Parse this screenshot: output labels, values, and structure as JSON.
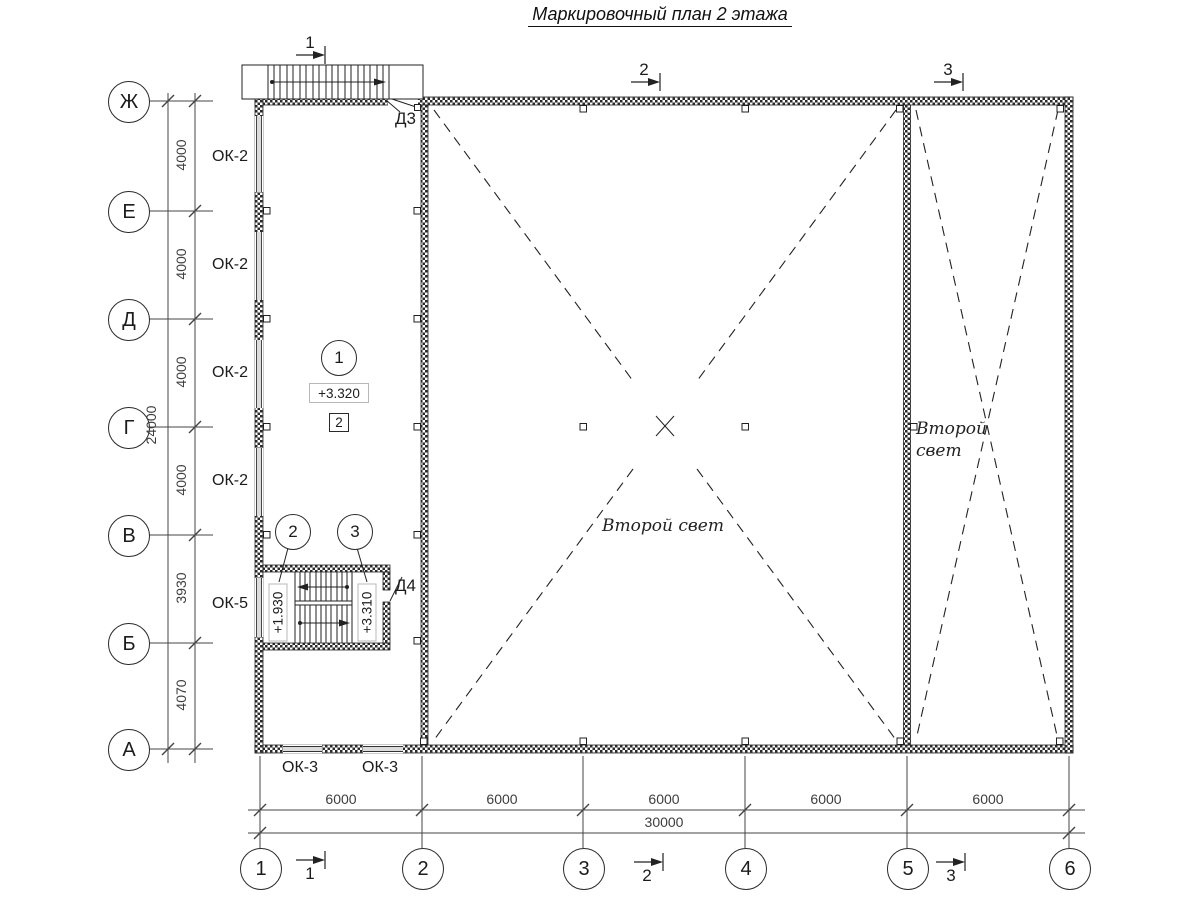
{
  "title": "Маркировочный план 2 этажа",
  "axes": {
    "rows": [
      "Ж",
      "Е",
      "Д",
      "Г",
      "В",
      "Б",
      "А"
    ],
    "cols": [
      "1",
      "2",
      "3",
      "4",
      "5",
      "6"
    ]
  },
  "dimensions": {
    "vertical_segments": [
      "4000",
      "4000",
      "4000",
      "4000",
      "3930",
      "4070"
    ],
    "vertical_total": "24000",
    "horizontal_segments": [
      "6000",
      "6000",
      "6000",
      "6000",
      "6000"
    ],
    "horizontal_total": "30000"
  },
  "marks": {
    "window_ok2": "ОК-2",
    "window_ok5": "ОК-5",
    "window_ok3": "ОК-3",
    "door_d3": "Д3",
    "door_d4": "Д4"
  },
  "levels": {
    "floor": "+3.320",
    "landing": "+1.930",
    "stair_top": "+3.310"
  },
  "callouts": {
    "node1": "1",
    "node2": "2",
    "node3": "3",
    "detail_box": "2"
  },
  "sections": {
    "s1": "1",
    "s2": "2",
    "s3": "3"
  },
  "second_light": {
    "center": "Второй свет",
    "right_line1": "Второй",
    "right_line2": "свет"
  },
  "colors": {
    "line": "#222222",
    "dim_line": "#444444",
    "background": "#ffffff"
  }
}
